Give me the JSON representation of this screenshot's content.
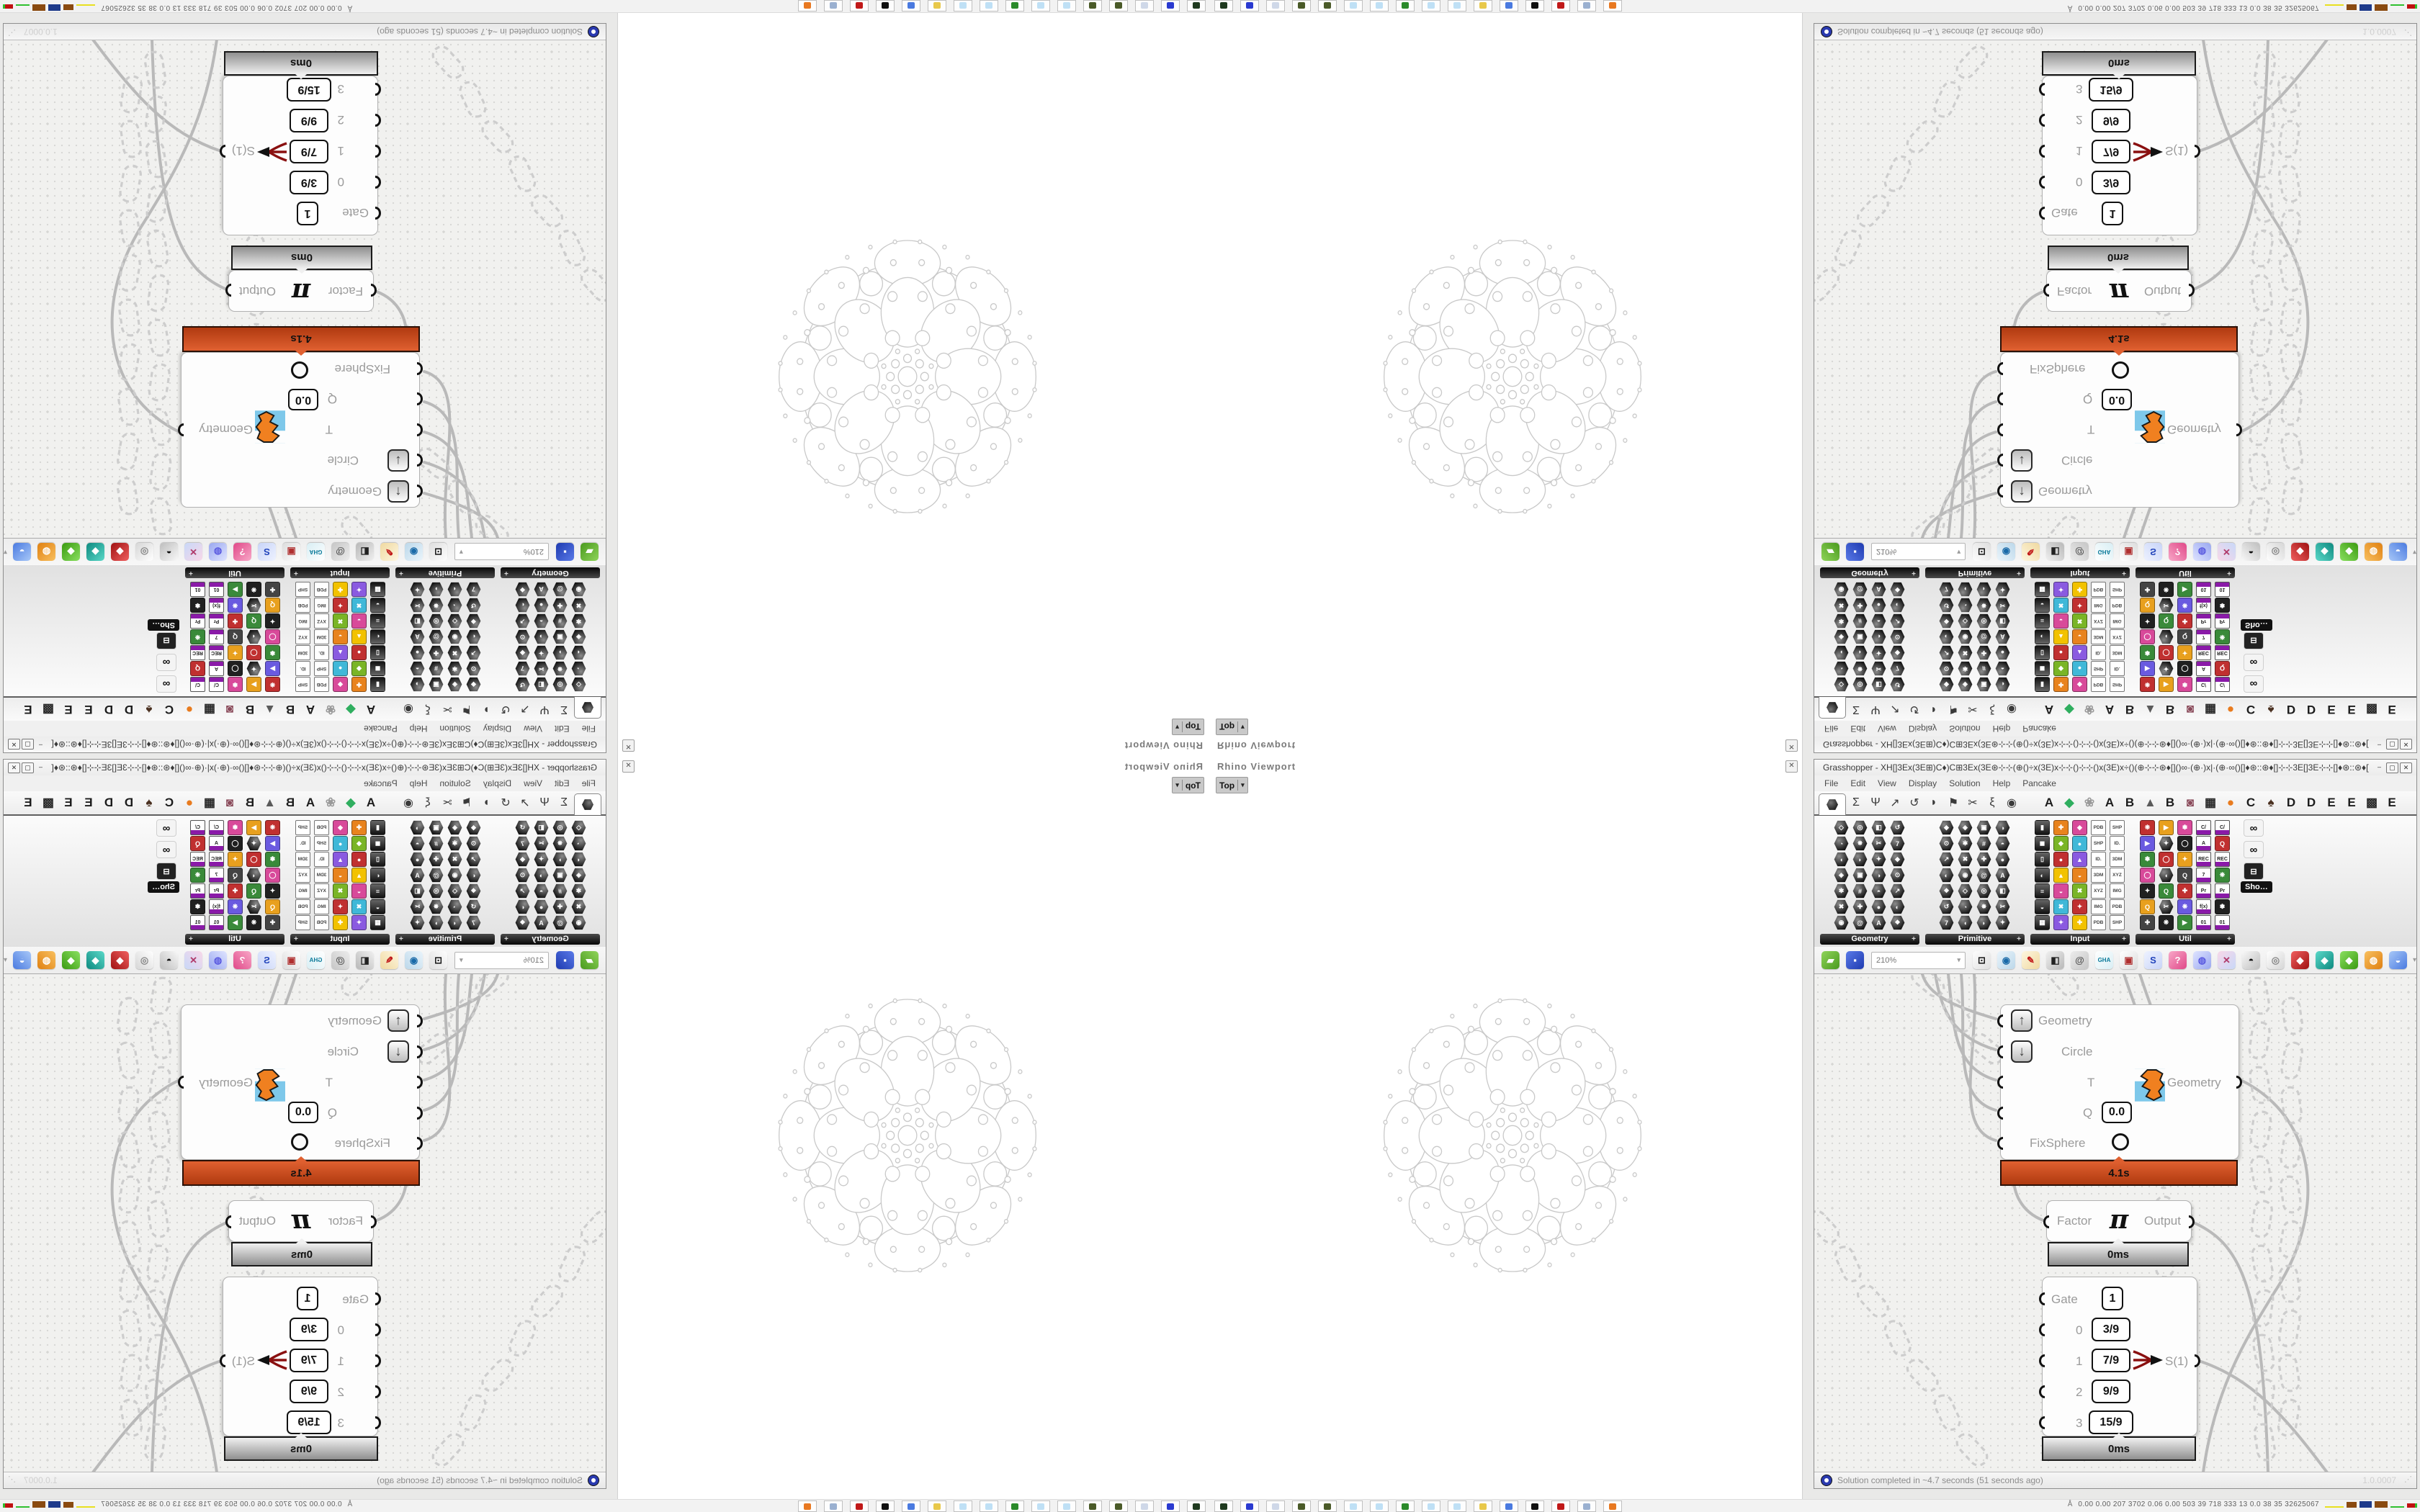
{
  "window": {
    "app": "Grasshopper",
    "title": "Grasshopper - XH[]3Ex(3E⊞)C♦)C⊞3Ex(3E⊛⊹⊹(⊕()÷x(3E)x⊹⊹()⊹⊹()x(3E)x÷()(⊕⊹⊹⊛♦[]()∞·(⊕·)x|·(⊕·∞()[]♦⊛::⊛♦[]⊹⊹3E[]3E⊹⊹[]♦⊛::⊛♦[]()∞·(⊕·)x|·(⊕·∞()[]♦⊛⊹⊹(⊕()⊹x(3E)x⊹⊹()⊹⊹()⊹⊹…",
    "minimize": "–",
    "maximize": "▢",
    "close": "✕"
  },
  "menu": {
    "items": [
      "File",
      "Edit",
      "View",
      "Display",
      "Solution",
      "Help",
      "Pancake"
    ]
  },
  "tabs": {
    "glyph_tabs": [
      "Σ",
      "Ψ",
      "↗",
      "↺",
      "◗",
      "⚑",
      "✂",
      "ξ",
      "◉"
    ],
    "plugin_tabs": [
      {
        "label": "A",
        "color": "#1c1c1c"
      },
      {
        "label": "◆",
        "color": "#2fae5f"
      },
      {
        "label": "❀",
        "color": "#9a9a9a"
      },
      {
        "label": "A",
        "color": "#1c1c1c"
      },
      {
        "label": "B",
        "color": "#1c1c1c"
      },
      {
        "label": "▲",
        "color": "#5a5a5a"
      },
      {
        "label": "B",
        "color": "#1c1c1c"
      },
      {
        "label": "◙",
        "color": "#8a4a5a"
      },
      {
        "label": "▦",
        "color": "#2a2a2a"
      },
      {
        "label": "●",
        "color": "#e87b1e"
      },
      {
        "label": "C",
        "color": "#1c1c1c"
      },
      {
        "label": "♠",
        "color": "#4a3020"
      },
      {
        "label": "D",
        "color": "#1c1c1c"
      },
      {
        "label": "D",
        "color": "#1c1c1c"
      },
      {
        "label": "E",
        "color": "#1c1c1c"
      },
      {
        "label": "E",
        "color": "#1c1c1c"
      },
      {
        "label": "▩",
        "color": "#2a2a2a"
      },
      {
        "label": "E",
        "color": "#1c1c1c"
      }
    ]
  },
  "panels": {
    "names": [
      "Geometry",
      "Primitive",
      "Input",
      "Util"
    ],
    "expander": "+",
    "tooltip": "Sho…",
    "input_tags": [
      "3DM",
      "XYZ",
      "IMG",
      "PDB",
      "SHP",
      "ID."
    ],
    "util_tags": [
      "C/",
      "A",
      "REC",
      "7",
      "Pr",
      "f(x)",
      "01"
    ]
  },
  "toolbar": {
    "zoom_level": "210%",
    "scroll_arrow": "▾",
    "icons": [
      {
        "name": "open-file-icon",
        "glyph": "▰",
        "c1": "#8fd45a",
        "c2": "#4a9a1e",
        "fg": "#ffffff"
      },
      {
        "name": "save-file-icon",
        "glyph": "▪",
        "c1": "#5a7ae8",
        "c2": "#1e3ab0",
        "fg": "#ffffff"
      },
      {
        "name": "zoom-extents-icon",
        "glyph": "⊡",
        "c1": "#fdfdfd",
        "c2": "#dedede",
        "fg": "#111111"
      },
      {
        "name": "preview-eye-icon",
        "glyph": "◉",
        "c1": "#eaf4fb",
        "c2": "#bcd8ea",
        "fg": "#1a6aa8"
      },
      {
        "name": "sketch-pen-icon",
        "glyph": "✎",
        "c1": "#fdf6e0",
        "c2": "#f0d9a0",
        "fg": "#c01818"
      },
      {
        "name": "preview-solid-icon",
        "glyph": "◧",
        "c1": "#f0f0f0",
        "c2": "#b8b8b8",
        "fg": "#222222"
      },
      {
        "name": "remote-definition-icon",
        "glyph": "@",
        "c1": "#ececec",
        "c2": "#c6c6c6",
        "fg": "#555555"
      },
      {
        "name": "gha-assembly-icon",
        "glyph": "GHA",
        "c1": "#ffffff",
        "c2": "#d8eef4",
        "fg": "#0a7a9a"
      },
      {
        "name": "screenshot-icon",
        "glyph": "▣",
        "c1": "#ffffff",
        "c2": "#dcdcdc",
        "fg": "#b03030"
      },
      {
        "name": "find-component-icon",
        "glyph": "S",
        "c1": "#eef2ff",
        "c2": "#c8d4f8",
        "fg": "#2244bb"
      },
      {
        "name": "gift-package-icon",
        "glyph": "?",
        "c1": "#f8a8c8",
        "c2": "#e04888",
        "fg": "#ffffff"
      },
      {
        "name": "galapagos-balloon-icon",
        "glyph": "◍",
        "c1": "#dfe4ff",
        "c2": "#9aa8f0",
        "fg": "#5a5ae0"
      },
      {
        "name": "cross-reference-icon",
        "glyph": "✕",
        "c1": "#f8d8e8",
        "c2": "#c8d8f8",
        "fg": "#b03a6a"
      },
      {
        "name": "cluster-spheres-icon",
        "glyph": "◓",
        "c1": "#f8f8f8",
        "c2": "#bebebe",
        "fg": "#111111"
      },
      {
        "name": "rings-icon",
        "glyph": "◎",
        "c1": "#ffffff",
        "c2": "#d6d6d6",
        "fg": "#888888"
      },
      {
        "name": "red-gem-icon",
        "glyph": "◆",
        "c1": "#f06060",
        "c2": "#a01010",
        "fg": "#ffffff"
      },
      {
        "name": "gem-teal-icon",
        "glyph": "◆",
        "c1": "#5ad8c8",
        "c2": "#0e8a80",
        "fg": "#ffffff"
      },
      {
        "name": "gem-green-icon",
        "glyph": "◆",
        "c1": "#8ae060",
        "c2": "#3a9a10",
        "fg": "#ffffff"
      },
      {
        "name": "gem-orange-icon",
        "glyph": "◍",
        "c1": "#f8c060",
        "c2": "#e08010",
        "fg": "#ffffff"
      },
      {
        "name": "gem-blue-icon",
        "glyph": "◒",
        "c1": "#a8c8f8",
        "c2": "#4a7ae0",
        "fg": "#ffffff"
      }
    ]
  },
  "viewport": {
    "title": "Rhino Viewport",
    "view": "Top",
    "dropdown": "▾",
    "close": "✕"
  },
  "canvas_components": {
    "solver": {
      "inputs": [
        "Geometry",
        "Circle",
        "T",
        "Q",
        "FixSphere"
      ],
      "q_value": "0.0",
      "output": "Geometry",
      "time": "4.1s"
    },
    "pi": {
      "input": "Factor",
      "symbol": "π",
      "output": "Output",
      "time": "0ms"
    },
    "selector": {
      "gate_label": "Gate",
      "gate_value": "1",
      "rows": [
        {
          "i": "0",
          "v": "3/9"
        },
        {
          "i": "1",
          "v": "7/9"
        },
        {
          "i": "2",
          "v": "9/9"
        },
        {
          "i": "3",
          "v": "15/9"
        }
      ],
      "output": "S(1)",
      "time": "0ms"
    }
  },
  "statusbar": {
    "message": "Solution completed in ~4.7 seconds (51 seconds ago)",
    "version": "1.0.0007",
    "grip": "⋰"
  },
  "taskbar": {
    "stats": "0.00 0.00  207  3702 0.06 0.00  503   39   718  333   13   0.0   38    35  32625067",
    "icons": [
      {
        "name": "gpu-widget-icon",
        "color": "#1f3a1f"
      },
      {
        "name": "floppy-64-icon",
        "color": "#2a3ad0"
      },
      {
        "name": "document-printer-icon",
        "color": "#cfd8e8"
      },
      {
        "name": "moss-ball-icon",
        "color": "#4a5a28"
      },
      {
        "name": "moss-ball-icon-2",
        "color": "#4a5a28"
      },
      {
        "name": "notepad-icon",
        "color": "#bfe0f5"
      },
      {
        "name": "notepad-icon-2",
        "color": "#bfe0f5"
      },
      {
        "name": "terminal-monitor-icon",
        "color": "#2a8a2a"
      },
      {
        "name": "notepad-icon-3",
        "color": "#bfe0f5"
      },
      {
        "name": "notepad-icon-4",
        "color": "#bfe0f5"
      },
      {
        "name": "folder-icon",
        "color": "#e8c84a"
      },
      {
        "name": "monitor-dialog-icon",
        "color": "#4a7ae0"
      },
      {
        "name": "black-bird-icon",
        "color": "#101010"
      },
      {
        "name": "red-wheel-icon",
        "color": "#c01818"
      },
      {
        "name": "calculator-icon",
        "color": "#9ab0d0"
      },
      {
        "name": "orange-globe-icon",
        "color": "#e87820"
      }
    ]
  },
  "colors": {
    "profiler_busy": "#cf4a1d",
    "profiler_idle": "#bfbfbf",
    "wire": "#b9b9b9",
    "chain": "#cdcdcd",
    "fractal_stroke": "#c9c9c9",
    "canvas_bg": "#f1f1ef"
  }
}
